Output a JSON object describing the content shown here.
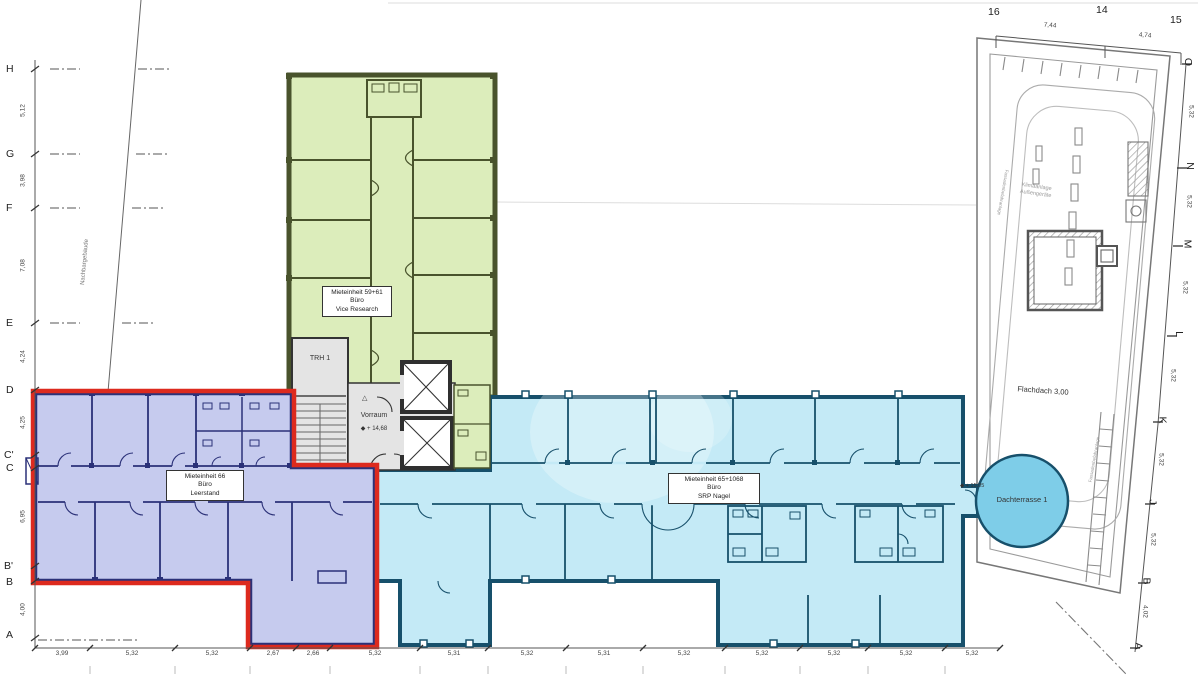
{
  "units": {
    "green": {
      "l1": "Mieteinheit 59+61",
      "l2": "Büro",
      "l3": "Vice Research"
    },
    "blue": {
      "l1": "Mieteinheit 66",
      "l2": "Büro",
      "l3": "Leerstand"
    },
    "cyan": {
      "l1": "Mieteinheit 65+1068",
      "l2": "Büro",
      "l3": "SRP Nagel"
    }
  },
  "core": {
    "stair": "TRH 1",
    "vorraum": "Vorraum",
    "level": "+ 14,68"
  },
  "roof": {
    "flachdach": "Flachdach 3,00",
    "terrasse": "Dachterrasse 1",
    "terrasse_level": "+ 15,05",
    "klima1": "Klimaanlage",
    "klima2": "Außengeräte",
    "fassade": "Fassadenbefahranlage"
  },
  "site": {
    "neighbor": "Nachbargebäude"
  },
  "grid_left": [
    "H",
    "G",
    "F",
    "E",
    "D",
    "C'",
    "C",
    "B'",
    "B",
    "A"
  ],
  "dims_left": [
    "5,12",
    "3,98",
    "7,08",
    "4,24",
    "4,25",
    "6,95",
    "4,00"
  ],
  "grid_top": [
    "16",
    "14",
    "15"
  ],
  "dims_top": [
    "7,44",
    "4,74"
  ],
  "grid_right": [
    "O",
    "N",
    "M",
    "L",
    "K",
    "J",
    "B",
    "A"
  ],
  "dims_right": [
    "5,32",
    "5,32",
    "5,32",
    "5,32",
    "5,32",
    "5,32",
    "4,02"
  ],
  "dims_bottom": [
    "3,99",
    "5,32",
    "5,32",
    "2,67",
    "2,66",
    "5,32",
    "5,31",
    "5,32",
    "5,31",
    "5,32",
    "5,32",
    "5,32",
    "5,32",
    "5,32"
  ],
  "colors": {
    "green_fill": "#dcedbb",
    "blue_fill": "#c6cbee",
    "cyan_fill": "#c4eaf6",
    "terrace_fill": "#7ecde8",
    "core_fill": "#e4e4e4",
    "red_outline": "#dd2a1e"
  }
}
